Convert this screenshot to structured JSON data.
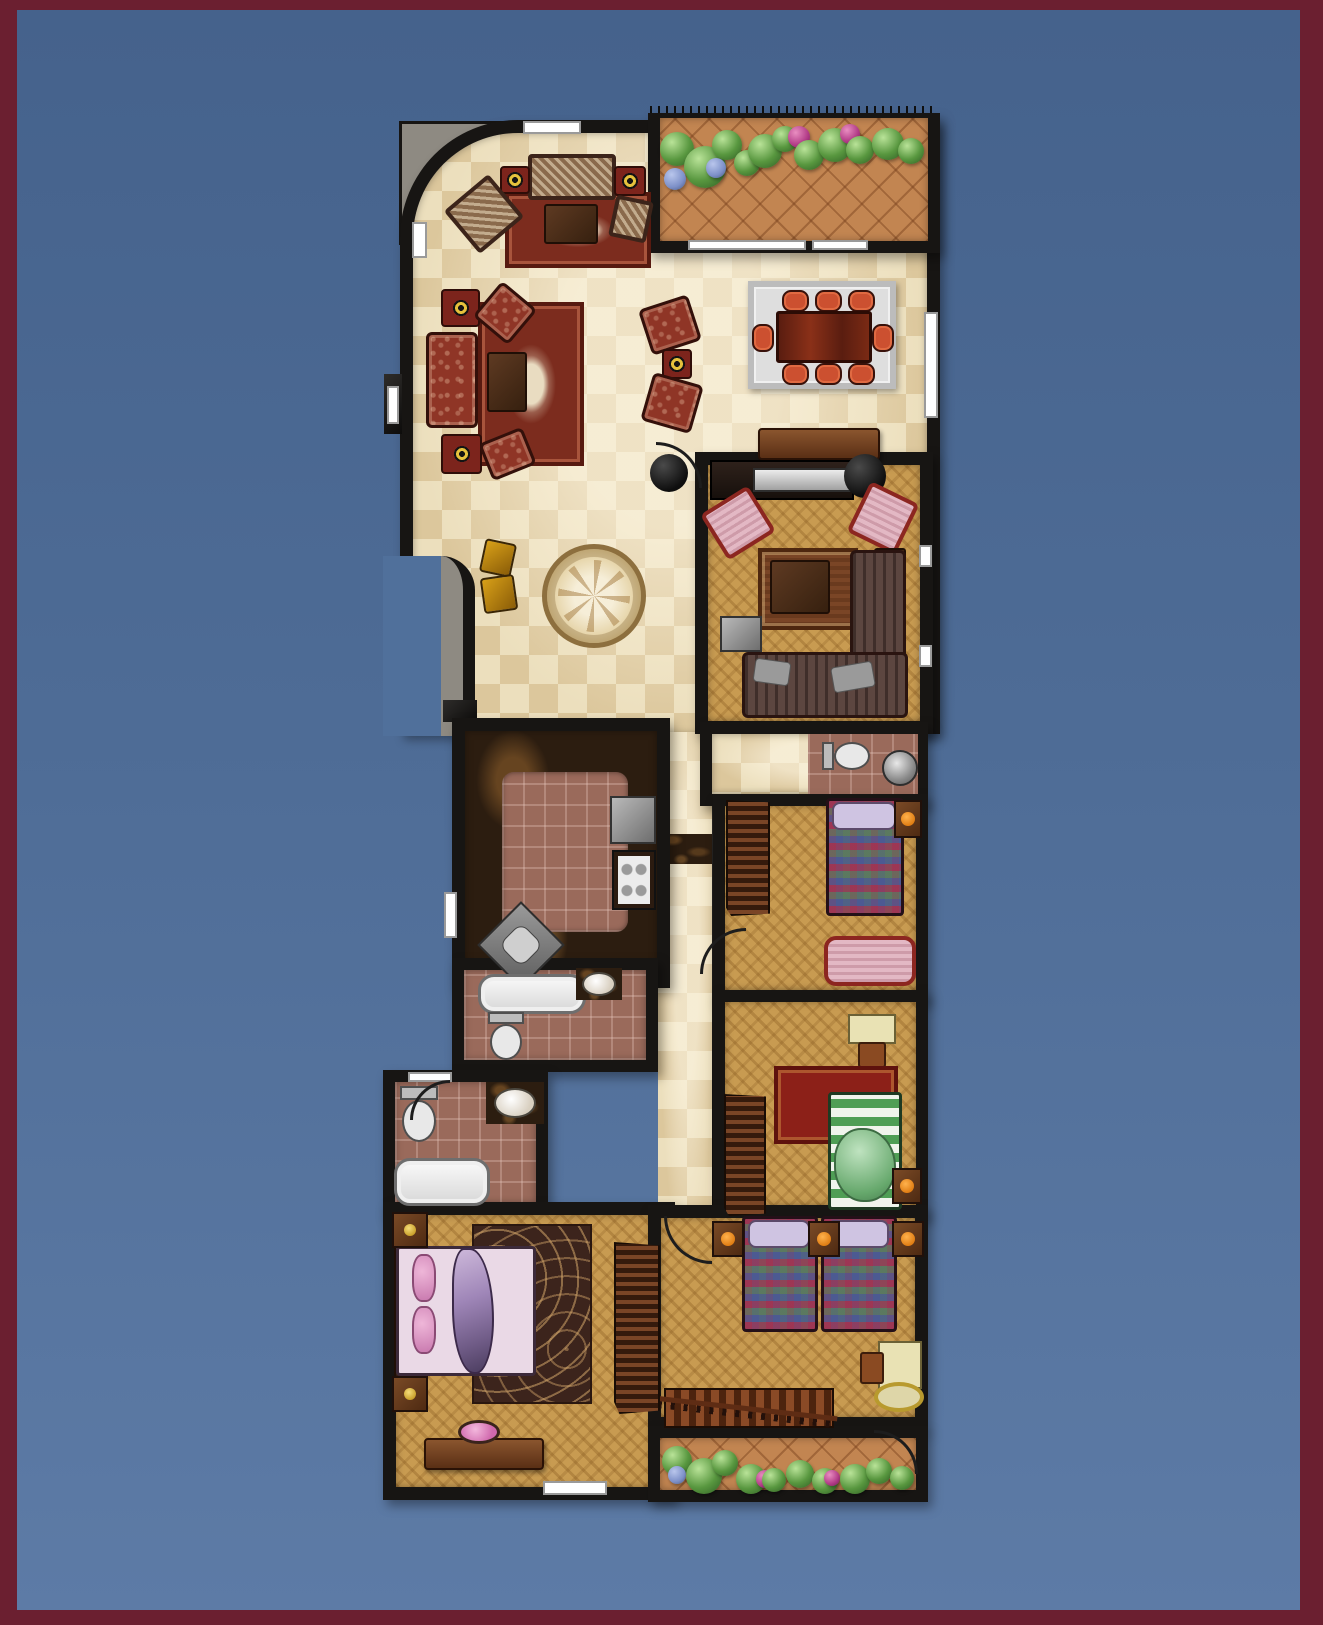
{
  "title": "Residential apartment floor plan (top-down render)",
  "frame": {
    "border_color": "#6b1f30",
    "background_top": "#45628c",
    "background_bottom": "#5d7ba6",
    "wall_color": "#171513"
  },
  "palette": {
    "marble_floor": "#ecdfbd",
    "parquet_floor": "#c89b51",
    "terracotta_floor": "#c28551",
    "bath_tile": "#9a6a5b",
    "counter_marble": "#2c1d10",
    "oriental_rug": "#7c2c1e",
    "dining_chair": "#cc5030",
    "plants_green": "#58973f",
    "plants_magenta": "#b13a86"
  },
  "rooms": {
    "living": {
      "label": "Living and reception hall",
      "furniture": [
        "woven sofa set with target-pattern ottomans",
        "two oriental rugs",
        "coffee tables",
        "paired floor chairs with side stool",
        "floor medallion mosaic",
        "black pouf",
        "two yellow stools"
      ]
    },
    "balcony": {
      "label": "Upper balcony with planting",
      "furniture": [
        "railing",
        "terracotta tile",
        "palms and flowering plants",
        "sliding glass doors"
      ]
    },
    "dining": {
      "label": "Dining area",
      "furniture": [
        "eight-seat dining table on gray rug",
        "sideboard"
      ]
    },
    "family": {
      "label": "Family TV room",
      "furniture": [
        "tv console",
        "two pink armchairs",
        "corner sectional sofa",
        "coffee table on patterned rug",
        "side tables"
      ]
    },
    "kitchen": {
      "label": "Kitchen",
      "furniture": [
        "L-shaped dark marble counter",
        "stove",
        "refrigerator",
        "corner sink"
      ]
    },
    "corridor": {
      "label": "Central corridor",
      "furniture": [
        "marble threshold"
      ]
    },
    "bath1": {
      "label": "Main bathroom",
      "furniture": [
        "bathtub",
        "toilet",
        "vanity sink"
      ]
    },
    "bath2": {
      "label": "Second bathroom",
      "furniture": [
        "toilet",
        "vanity sink",
        "bathtub"
      ]
    },
    "hallbath": {
      "label": "Bedroom hall with small bathroom",
      "furniture": [
        "toilet",
        "round basin"
      ]
    },
    "kid1": {
      "label": "Bedroom 1",
      "furniture": [
        "wardrobe",
        "single plaid bed",
        "nightstand",
        "loveseat"
      ]
    },
    "kid2": {
      "label": "Bedroom 2",
      "furniture": [
        "desk with chair",
        "red rug",
        "green striped bed",
        "wardrobe",
        "nightstand"
      ]
    },
    "twin": {
      "label": "Twin bedroom",
      "furniture": [
        "two plaid beds",
        "three nightstands",
        "desk with chair",
        "round rug"
      ]
    },
    "master": {
      "label": "Master bedroom",
      "furniture": [
        "double bed with pink linens",
        "swirl rug",
        "wardrobe",
        "dresser with mirror",
        "two nightstands"
      ]
    },
    "stairs": {
      "label": "Staircase",
      "furniture": [
        "wood steps",
        "balustrade"
      ]
    },
    "terrace": {
      "label": "Lower terrace with planting",
      "furniture": [
        "terracotta tile",
        "plants"
      ]
    }
  }
}
